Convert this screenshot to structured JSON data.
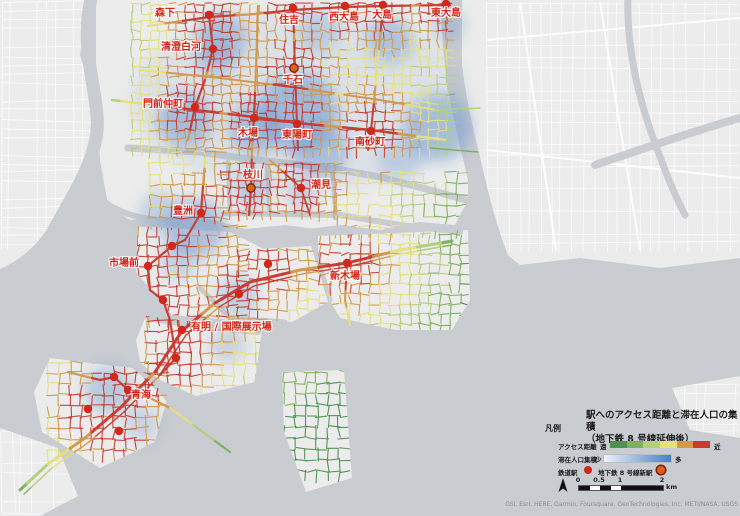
{
  "legend": {
    "section_label": "凡例",
    "title_line1": "駅へのアクセス距離と滞在人口の集積",
    "title_line2": "（地下鉄 8 号線延伸後）",
    "access": {
      "label": "アクセス距離",
      "far": "遠",
      "near": "近",
      "colors": [
        "#4e9152",
        "#7fb061",
        "#b4cf7d",
        "#e7e07c",
        "#d2984c",
        "#c63b30"
      ]
    },
    "population": {
      "label": "滞在人口集積",
      "low": "少",
      "high": "多",
      "color_start": "#eef2f8",
      "color_end": "#4a7fc4"
    },
    "stations": {
      "rail_label": "鉄道駅",
      "rail_color": "#d0281c",
      "new_label": "地下鉄 8 号線新駅",
      "new_color": "#e06018",
      "new_ring": "#7e1d07"
    },
    "scalebar": {
      "ticks": [
        "0",
        "0.5",
        "1",
        "2"
      ],
      "unit": "km"
    },
    "attribution": "GSI, Esri, HERE, Garmin, Foursquare, GeoTechnologies, Inc, METI/NASA, USGS"
  },
  "map": {
    "colors": {
      "water": "#c9ccd0",
      "land": "#ebeceb",
      "street": "#ffffff",
      "heat": "#6f97cf"
    },
    "access_ramp": [
      "#4e9152",
      "#7fb061",
      "#b4cf7d",
      "#e7e07c",
      "#d2984c",
      "#c63b30"
    ],
    "stations": [
      {
        "name": "森下",
        "x": 209,
        "y": 15,
        "lx": 155,
        "ly": 9,
        "type": "rail"
      },
      {
        "name": "住吉",
        "x": 293,
        "y": 8,
        "lx": 279,
        "ly": 16,
        "type": "rail"
      },
      {
        "name": "西大島",
        "x": 345,
        "y": 6,
        "lx": 329,
        "ly": 13,
        "type": "rail"
      },
      {
        "name": "大島",
        "x": 383,
        "y": 5,
        "lx": 372,
        "ly": 11,
        "type": "rail"
      },
      {
        "name": "東大島",
        "x": 446,
        "y": 4,
        "lx": 431,
        "ly": 9,
        "type": "rail"
      },
      {
        "name": "清澄白河",
        "x": 213,
        "y": 49,
        "lx": 161,
        "ly": 43,
        "type": "rail"
      },
      {
        "name": "千石",
        "x": 294,
        "y": 68,
        "lx": 283,
        "ly": 76,
        "type": "new"
      },
      {
        "name": "門前仲町",
        "x": 195,
        "y": 107,
        "lx": 143,
        "ly": 100,
        "type": "rail"
      },
      {
        "name": "木場",
        "x": 254,
        "y": 118,
        "lx": 238,
        "ly": 129,
        "type": "rail"
      },
      {
        "name": "東陽町",
        "x": 297,
        "y": 124,
        "lx": 282,
        "ly": 131,
        "type": "rail"
      },
      {
        "name": "南砂町",
        "x": 371,
        "y": 131,
        "lx": 355,
        "ly": 138,
        "type": "rail"
      },
      {
        "name": "枝川",
        "x": 251,
        "y": 188,
        "lx": 243,
        "ly": 171,
        "type": "new"
      },
      {
        "name": "潮見",
        "x": 301,
        "y": 188,
        "lx": 311,
        "ly": 181,
        "type": "rail"
      },
      {
        "name": "豊洲",
        "x": 201,
        "y": 213,
        "lx": 173,
        "ly": 207,
        "type": "rail"
      },
      {
        "name": "市場前",
        "x": 148,
        "y": 266,
        "lx": 109,
        "ly": 259,
        "type": "rail"
      },
      {
        "name": "新木場",
        "x": 347,
        "y": 263,
        "lx": 330,
        "ly": 272,
        "type": "rail"
      },
      {
        "name": "有明 / 国際展示場",
        "x": 182,
        "y": 330,
        "lx": 191,
        "ly": 323,
        "type": "rail"
      },
      {
        "name": "青海",
        "x": 128,
        "y": 390,
        "lx": 131,
        "ly": 391,
        "type": "rail"
      }
    ],
    "unlabeled_stations": [
      {
        "x": 172,
        "y": 246
      },
      {
        "x": 163,
        "y": 300
      },
      {
        "x": 239,
        "y": 294
      },
      {
        "x": 268,
        "y": 264
      },
      {
        "x": 114,
        "y": 377
      },
      {
        "x": 176,
        "y": 358
      },
      {
        "x": 88,
        "y": 409
      },
      {
        "x": 119,
        "y": 431
      }
    ]
  }
}
